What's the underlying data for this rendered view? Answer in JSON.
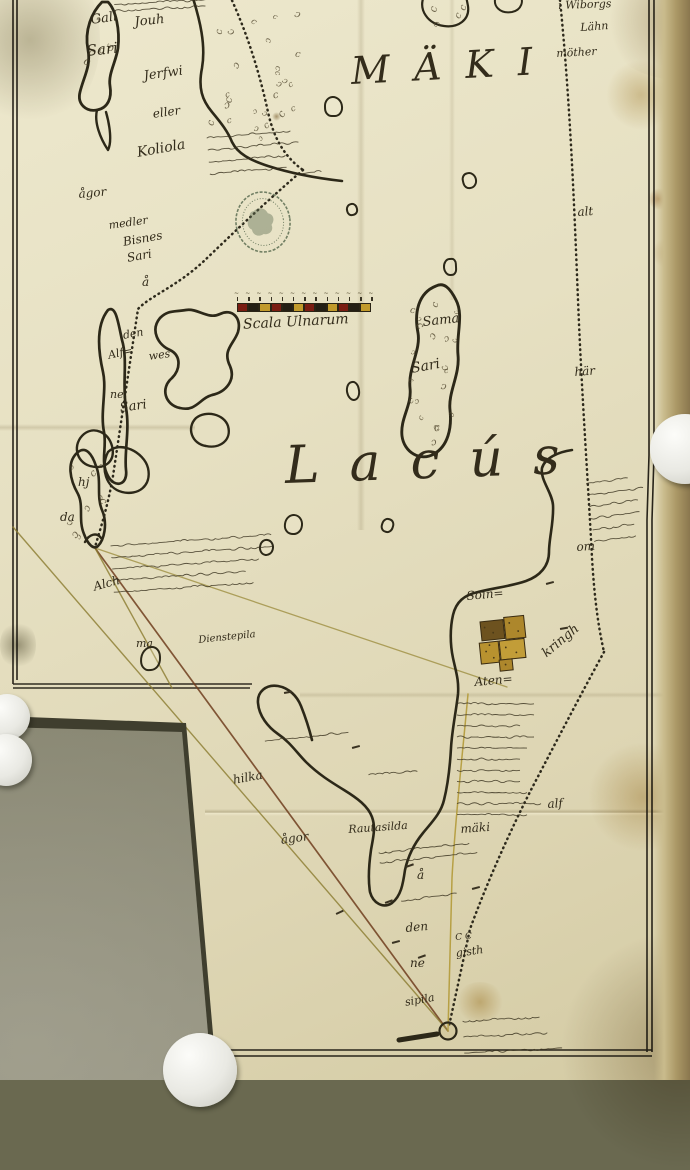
{
  "map": {
    "major_names": {
      "lake": "Lacús",
      "region": "MÄKI"
    },
    "scale": {
      "label": "Scala Ulnarum",
      "segments": 12,
      "segment_colors": [
        "#7a1d12",
        "#241f14",
        "#c19a2b"
      ]
    },
    "colors": {
      "paper": "#e7e1c4",
      "ink": "#2c2818",
      "boundary_dots": "#2e2a1c",
      "survey_red": "#6f3d1d",
      "survey_olive": "#8a7a2e",
      "survey_yellow": "#b29a38",
      "stamp_ink": "#5d6e53",
      "village_gold": "#b8922f",
      "village_brown": "#6d521f",
      "table": "#6a6950"
    },
    "labels": [
      {
        "text": "Gall",
        "x": 90,
        "y": 14,
        "size": 13,
        "rot": -8
      },
      {
        "text": "Sari",
        "x": 86,
        "y": 44,
        "size": 15,
        "rot": -6
      },
      {
        "text": "Jouh",
        "x": 134,
        "y": 16,
        "size": 13,
        "rot": -6
      },
      {
        "text": "Jerfwi",
        "x": 143,
        "y": 70,
        "size": 13,
        "rot": -8
      },
      {
        "text": "eller",
        "x": 152,
        "y": 108,
        "size": 12,
        "rot": -8
      },
      {
        "text": "Koliola",
        "x": 136,
        "y": 146,
        "size": 14,
        "rot": -10
      },
      {
        "text": "ågor",
        "x": 78,
        "y": 188,
        "size": 12,
        "rot": -5
      },
      {
        "text": "medler",
        "x": 108,
        "y": 220,
        "size": 11,
        "rot": -8
      },
      {
        "text": "Bisnes",
        "x": 122,
        "y": 236,
        "size": 12,
        "rot": -10
      },
      {
        "text": "Sari",
        "x": 126,
        "y": 252,
        "size": 12,
        "rot": -10
      },
      {
        "text": "å",
        "x": 142,
        "y": 276,
        "size": 12,
        "rot": 0
      },
      {
        "text": "MÄKI",
        "x": 350,
        "y": 52,
        "size": 38,
        "rot": -3,
        "ls": 24
      },
      {
        "text": "i Wiborgs",
        "x": 558,
        "y": 0,
        "size": 11,
        "rot": -2
      },
      {
        "text": "Lähn",
        "x": 580,
        "y": 22,
        "size": 11,
        "rot": -4
      },
      {
        "text": "möther",
        "x": 556,
        "y": 48,
        "size": 11,
        "rot": -3
      },
      {
        "text": "alt",
        "x": 577,
        "y": 206,
        "size": 12,
        "rot": -4
      },
      {
        "text": "här",
        "x": 574,
        "y": 366,
        "size": 12,
        "rot": -4
      },
      {
        "text": "om",
        "x": 576,
        "y": 541,
        "size": 12,
        "rot": -4
      },
      {
        "text": "den",
        "x": 122,
        "y": 330,
        "size": 11,
        "rot": -10
      },
      {
        "text": "Alf=",
        "x": 107,
        "y": 350,
        "size": 11,
        "rot": -12
      },
      {
        "text": "wes",
        "x": 148,
        "y": 351,
        "size": 11,
        "rot": -8
      },
      {
        "text": "ne",
        "x": 110,
        "y": 389,
        "size": 11,
        "rot": 0
      },
      {
        "text": "Sari",
        "x": 119,
        "y": 402,
        "size": 13,
        "rot": -8
      },
      {
        "text": "Sama",
        "x": 422,
        "y": 316,
        "size": 13,
        "rot": -6
      },
      {
        "text": "Sari",
        "x": 410,
        "y": 362,
        "size": 14,
        "rot": -10
      },
      {
        "text": "Lacús",
        "x": 284,
        "y": 440,
        "size": 52,
        "rot": -2,
        "ls": 30
      },
      {
        "text": "hj",
        "x": 78,
        "y": 476,
        "size": 12,
        "rot": 0
      },
      {
        "text": "da",
        "x": 60,
        "y": 511,
        "size": 12,
        "rot": 0
      },
      {
        "text": "Alch",
        "x": 92,
        "y": 581,
        "size": 12,
        "rot": -15
      },
      {
        "text": "ma",
        "x": 136,
        "y": 638,
        "size": 11,
        "rot": 0
      },
      {
        "text": "Dienstepila",
        "x": 198,
        "y": 636,
        "size": 10,
        "rot": -6
      },
      {
        "text": "Soin=",
        "x": 466,
        "y": 590,
        "size": 12,
        "rot": -5
      },
      {
        "text": "Aten=",
        "x": 474,
        "y": 676,
        "size": 12,
        "rot": -5
      },
      {
        "text": "kringh",
        "x": 540,
        "y": 650,
        "size": 13,
        "rot": -40
      },
      {
        "text": "alf",
        "x": 547,
        "y": 798,
        "size": 12,
        "rot": -4
      },
      {
        "text": "hilka",
        "x": 232,
        "y": 774,
        "size": 12,
        "rot": -10
      },
      {
        "text": "ågor",
        "x": 280,
        "y": 834,
        "size": 12,
        "rot": -8
      },
      {
        "text": "Rautasilda",
        "x": 348,
        "y": 824,
        "size": 11,
        "rot": -4
      },
      {
        "text": "mäki",
        "x": 460,
        "y": 823,
        "size": 12,
        "rot": -4
      },
      {
        "text": "å",
        "x": 417,
        "y": 869,
        "size": 12,
        "rot": 0
      },
      {
        "text": "den",
        "x": 405,
        "y": 922,
        "size": 12,
        "rot": -5
      },
      {
        "text": "ne",
        "x": 410,
        "y": 957,
        "size": 12,
        "rot": 0
      },
      {
        "text": "C C",
        "x": 455,
        "y": 934,
        "size": 9,
        "rot": -5
      },
      {
        "text": "gisth",
        "x": 455,
        "y": 948,
        "size": 11,
        "rot": -8
      },
      {
        "text": "sipila",
        "x": 404,
        "y": 997,
        "size": 11,
        "rot": -10
      }
    ],
    "scribbles": [
      {
        "x": 112,
        "y": 0,
        "w": 118,
        "h": 13,
        "lines": 2,
        "rot": -3
      },
      {
        "x": 204,
        "y": 130,
        "w": 98,
        "h": 48,
        "lines": 4,
        "rot": -5
      },
      {
        "x": 298,
        "y": 168,
        "w": 26,
        "h": 8,
        "lines": 1,
        "rot": -5
      },
      {
        "x": 108,
        "y": 538,
        "w": 175,
        "h": 58,
        "lines": 5,
        "rot": -4
      },
      {
        "x": 262,
        "y": 733,
        "w": 115,
        "h": 12,
        "lines": 1,
        "rot": -6
      },
      {
        "x": 366,
        "y": 768,
        "w": 62,
        "h": 10,
        "lines": 1,
        "rot": -4
      },
      {
        "x": 455,
        "y": 696,
        "w": 88,
        "h": 122,
        "lines": 11,
        "rot": 0
      },
      {
        "x": 583,
        "y": 476,
        "w": 58,
        "h": 70,
        "lines": 6,
        "rot": -8
      },
      {
        "x": 376,
        "y": 846,
        "w": 104,
        "h": 20,
        "lines": 2,
        "rot": -6
      },
      {
        "x": 398,
        "y": 893,
        "w": 70,
        "h": 12,
        "lines": 1,
        "rot": -8
      },
      {
        "x": 460,
        "y": 1010,
        "w": 108,
        "h": 48,
        "lines": 3,
        "rot": -3
      }
    ],
    "islets": [
      {
        "x": 324,
        "y": 96,
        "w": 15,
        "h": 17
      },
      {
        "x": 462,
        "y": 172,
        "w": 11,
        "h": 13
      },
      {
        "x": 346,
        "y": 203,
        "w": 8,
        "h": 9
      },
      {
        "x": 443,
        "y": 258,
        "w": 10,
        "h": 14
      },
      {
        "x": 346,
        "y": 381,
        "w": 10,
        "h": 16
      },
      {
        "x": 284,
        "y": 514,
        "w": 15,
        "h": 17
      },
      {
        "x": 259,
        "y": 539,
        "w": 11,
        "h": 13
      },
      {
        "x": 381,
        "y": 518,
        "w": 9,
        "h": 11
      },
      {
        "x": 140,
        "y": 646,
        "w": 17,
        "h": 21
      }
    ],
    "texture_regions": [
      {
        "x": 208,
        "y": 8,
        "w": 92,
        "h": 128,
        "count": 26
      },
      {
        "x": 408,
        "y": 298,
        "w": 48,
        "h": 140,
        "count": 20
      },
      {
        "x": 64,
        "y": 458,
        "w": 38,
        "h": 78,
        "count": 9
      },
      {
        "x": 82,
        "y": 16,
        "w": 34,
        "h": 80,
        "count": 6
      },
      {
        "x": 428,
        "y": 2,
        "w": 38,
        "h": 22,
        "count": 4
      }
    ],
    "tick_marks": [
      {
        "x": 385,
        "y": 902,
        "rot": -20
      },
      {
        "x": 392,
        "y": 942,
        "rot": -15
      },
      {
        "x": 284,
        "y": 692,
        "rot": -10
      },
      {
        "x": 336,
        "y": 913,
        "rot": -25
      },
      {
        "x": 418,
        "y": 957,
        "rot": -20
      },
      {
        "x": 546,
        "y": 583,
        "rot": -15
      },
      {
        "x": 352,
        "y": 747,
        "rot": -15
      },
      {
        "x": 406,
        "y": 866,
        "rot": -20
      },
      {
        "x": 560,
        "y": 628,
        "rot": -10
      },
      {
        "x": 472,
        "y": 888,
        "rot": -15
      }
    ],
    "stamp": {
      "type": "oval-seal",
      "legible": false
    }
  }
}
